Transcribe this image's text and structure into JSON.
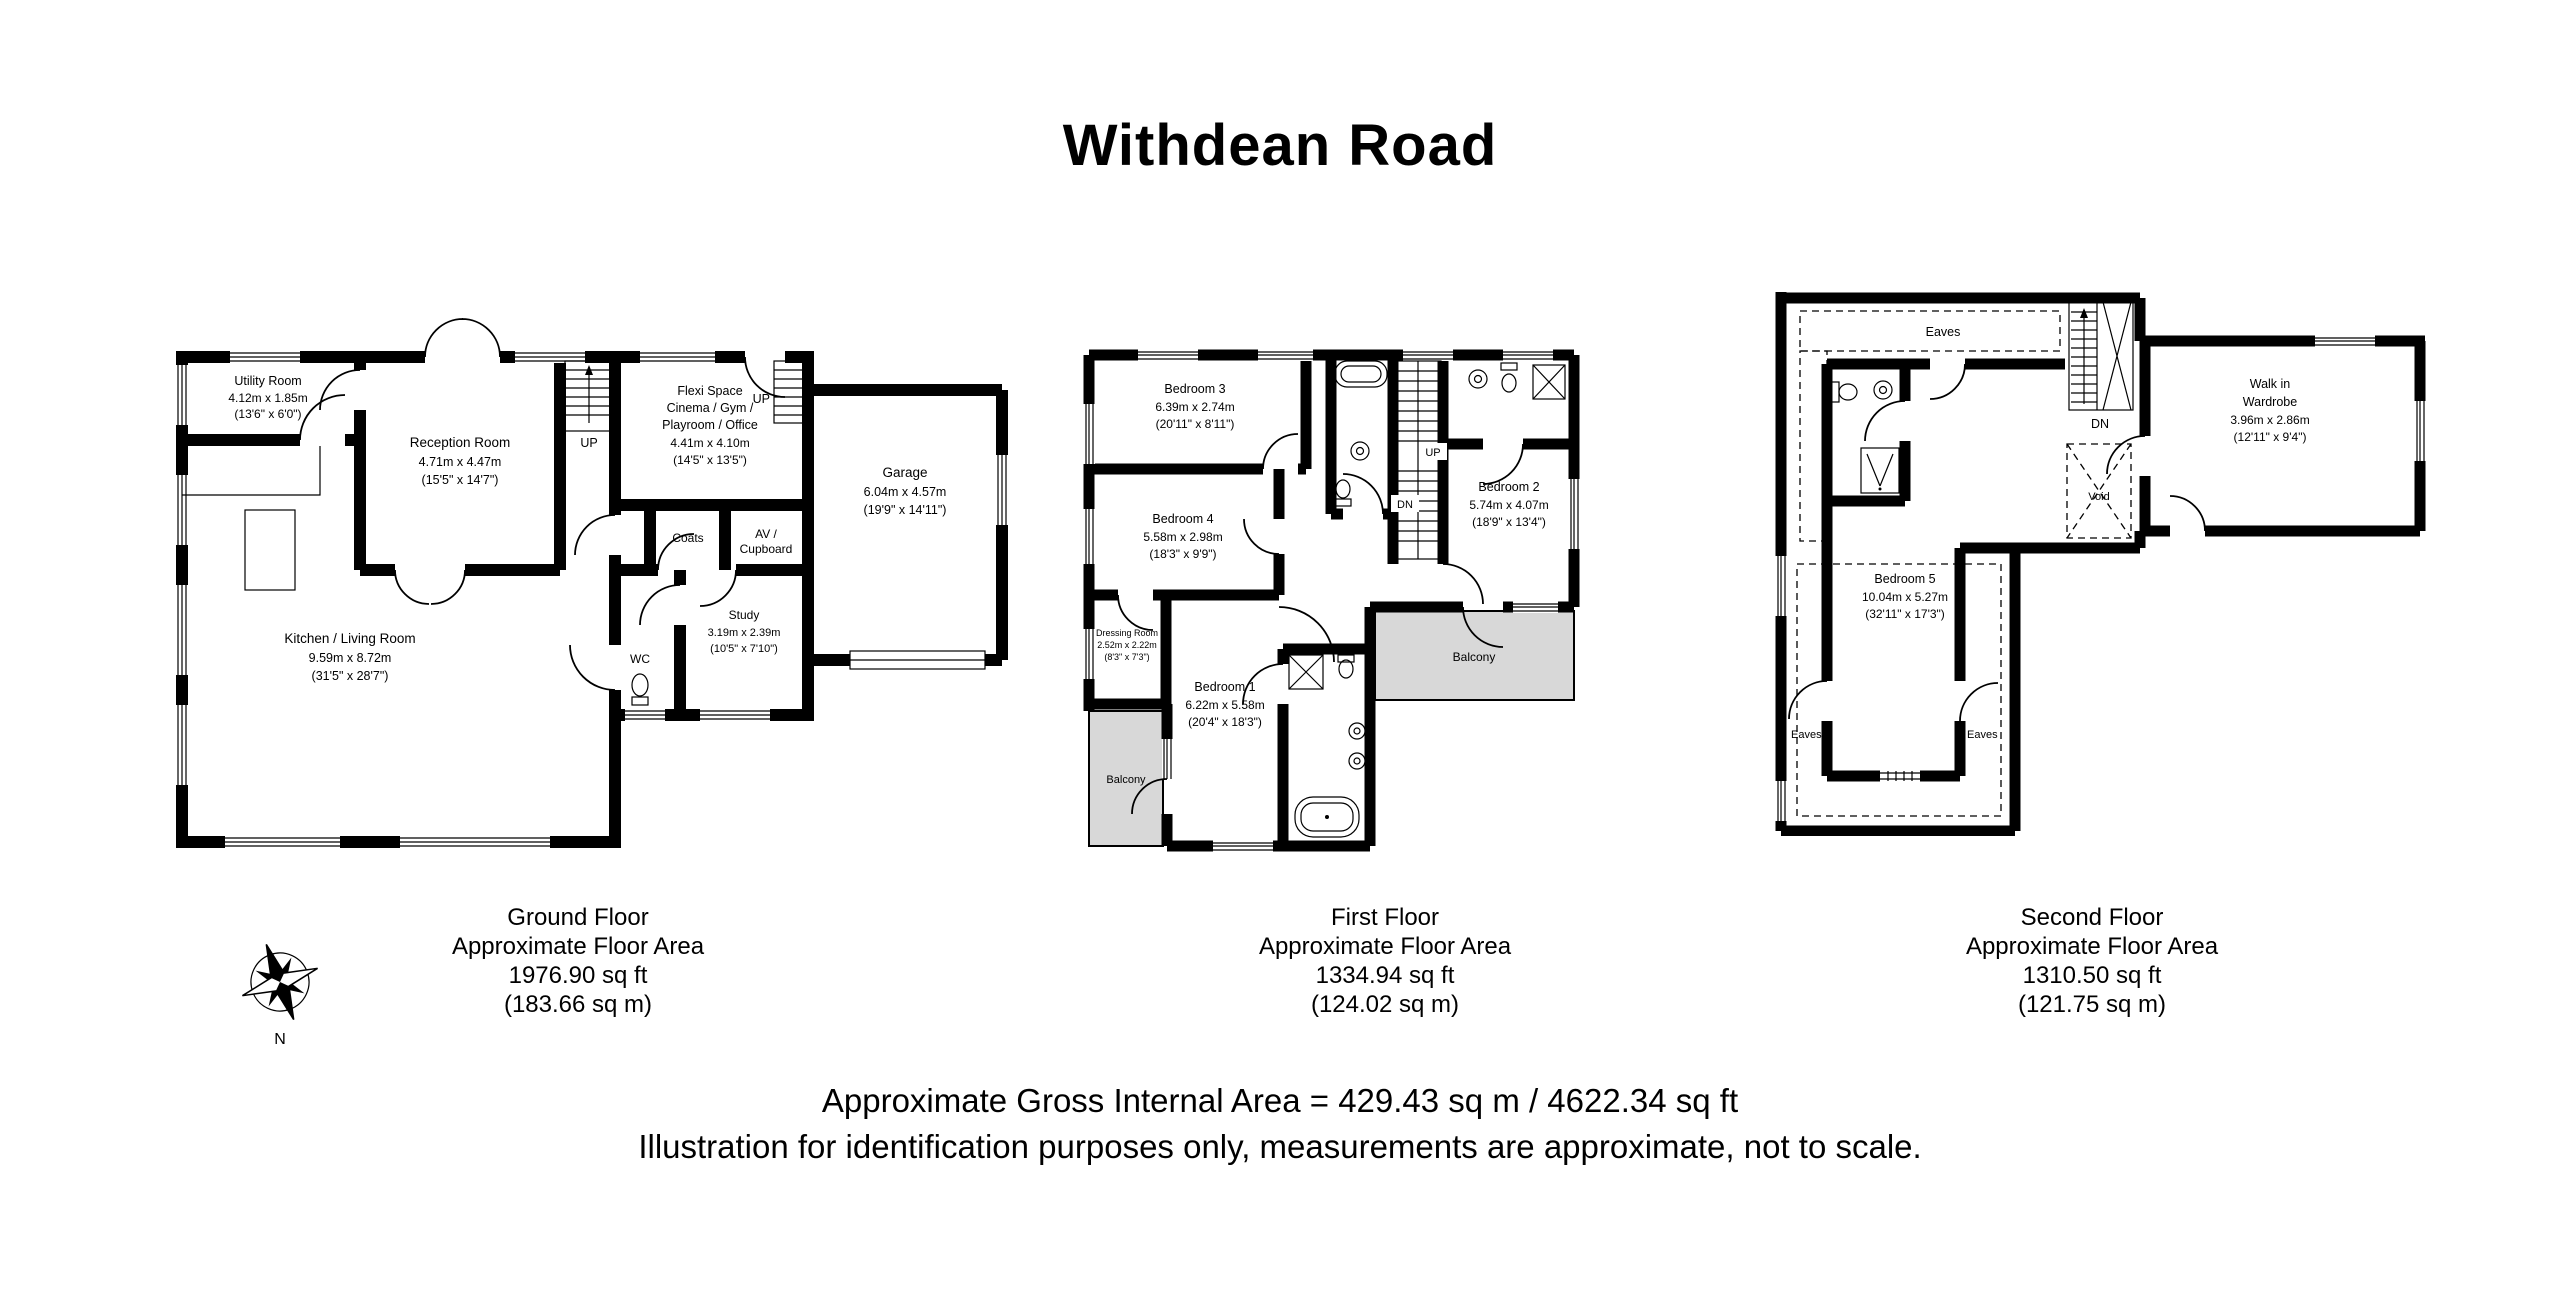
{
  "title": "Withdean Road",
  "colors": {
    "wall": "#000000",
    "balcony_fill": "#d8d8d8",
    "background": "#ffffff"
  },
  "ground_floor": {
    "rooms": {
      "utility": {
        "name": "Utility Room",
        "dims_m": "4.12m x 1.85m",
        "dims_ft": "(13'6\" x 6'0\")"
      },
      "reception": {
        "name": "Reception Room",
        "dims_m": "4.71m x 4.47m",
        "dims_ft": "(15'5\" x 14'7\")"
      },
      "kitchen": {
        "name": "Kitchen / Living Room",
        "dims_m": "9.59m x 8.72m",
        "dims_ft": "(31'5\" x 28'7\")"
      },
      "flexi": {
        "name1": "Flexi Space",
        "name2": "Cinema / Gym /",
        "name3": "Playroom / Office",
        "dims_m": "4.41m x 4.10m",
        "dims_ft": "(14'5\" x 13'5\")"
      },
      "garage": {
        "name": "Garage",
        "dims_m": "6.04m x 4.57m",
        "dims_ft": "(19'9\" x 14'11\")"
      },
      "study": {
        "name": "Study",
        "dims_m": "3.19m x 2.39m",
        "dims_ft": "(10'5\" x 7'10\")"
      },
      "coats": {
        "name": "Coats"
      },
      "av_cupboard": {
        "name1": "AV /",
        "name2": "Cupboard"
      },
      "wc": {
        "name": "WC"
      }
    },
    "labels": {
      "up_main": "UP",
      "up_flexi": "UP"
    },
    "caption": {
      "line1": "Ground Floor",
      "line2": "Approximate Floor Area",
      "line3": "1976.90 sq ft",
      "line4": "(183.66 sq m)"
    }
  },
  "first_floor": {
    "rooms": {
      "bedroom3": {
        "name": "Bedroom 3",
        "dims_m": "6.39m x 2.74m",
        "dims_ft": "(20'11\" x 8'11\")"
      },
      "bedroom4": {
        "name": "Bedroom 4",
        "dims_m": "5.58m x 2.98m",
        "dims_ft": "(18'3\" x 9'9\")"
      },
      "bedroom2": {
        "name": "Bedroom 2",
        "dims_m": "5.74m x 4.07m",
        "dims_ft": "(18'9\" x 13'4\")"
      },
      "bedroom1": {
        "name": "Bedroom 1",
        "dims_m": "6.22m x 5.58m",
        "dims_ft": "(20'4\" x 18'3\")"
      },
      "dressing": {
        "name": "Dressing Room",
        "dims_m": "2.52m x 2.22m",
        "dims_ft": "(8'3\" x 7'3\")"
      },
      "balcony_left": {
        "name": "Balcony"
      },
      "balcony_right": {
        "name": "Balcony"
      }
    },
    "labels": {
      "up": "UP",
      "dn": "DN"
    },
    "caption": {
      "line1": "First Floor",
      "line2": "Approximate Floor Area",
      "line3": "1334.94 sq ft",
      "line4": "(124.02 sq m)"
    }
  },
  "second_floor": {
    "rooms": {
      "bedroom5": {
        "name": "Bedroom 5",
        "dims_m": "10.04m x 5.27m",
        "dims_ft": "(32'11\" x 17'3\")"
      },
      "wardrobe": {
        "name1": "Walk in",
        "name2": "Wardrobe",
        "dims_m": "3.96m x 2.86m",
        "dims_ft": "(12'11\" x 9'4\")"
      }
    },
    "labels": {
      "dn": "DN",
      "void": "Void",
      "eaves_top": "Eaves",
      "eaves_left": "Eaves",
      "eaves_right": "Eaves"
    },
    "caption": {
      "line1": "Second Floor",
      "line2": "Approximate Floor Area",
      "line3": "1310.50 sq ft",
      "line4": "(121.75 sq m)"
    }
  },
  "compass": {
    "north": "N"
  },
  "footer": {
    "line1": "Approximate Gross Internal Area = 429.43 sq m / 4622.34 sq ft",
    "line2": "Illustration for identification purposes only, measurements are approximate, not to scale."
  }
}
